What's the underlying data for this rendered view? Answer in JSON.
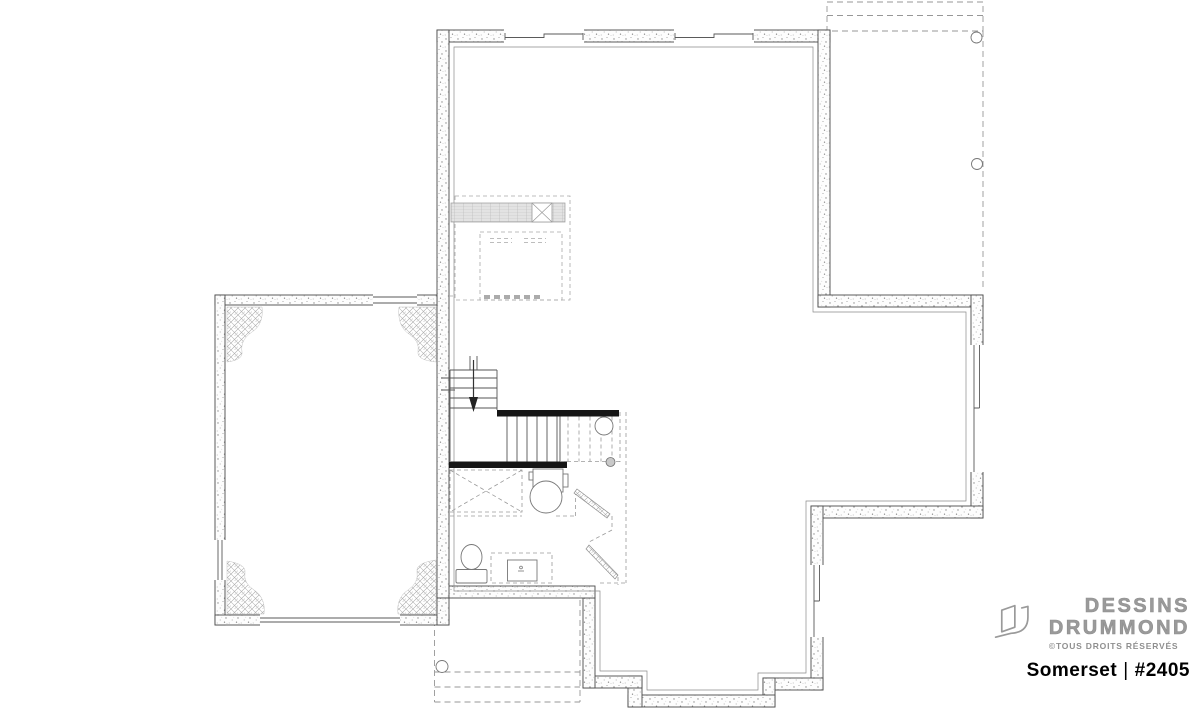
{
  "brand": {
    "name_line1": "DESSINS",
    "name_line2": "DRUMMOND",
    "copyright": "©TOUS DROITS RÉSERVÉS",
    "logo_icon": "drummond-d-logo"
  },
  "plan": {
    "name": "Somerset",
    "separator": "|",
    "number": "#2405",
    "title": "Somerset | #2405"
  },
  "colors": {
    "background": "#ffffff",
    "line": "#4a4a4a",
    "dashed": "#979797",
    "black_wall": "#151515",
    "brand_gray": "#9a9a9a",
    "title_color": "#000000"
  },
  "floorplan": {
    "type": "basement-floor-plan",
    "rooms": [
      "unfinished-basement",
      "garage",
      "future-bathroom-laundry",
      "stairwell"
    ],
    "icons": [
      "stairs-down-arrow",
      "support-column",
      "floor-drain",
      "laundry-tub",
      "toilet",
      "vanity-sink",
      "window",
      "garage-door-opening",
      "deck-post",
      "porch-post",
      "hvac-duct",
      "future-fixture-crossbox",
      "angled-door-leaf",
      "concrete-frost-pad"
    ]
  }
}
